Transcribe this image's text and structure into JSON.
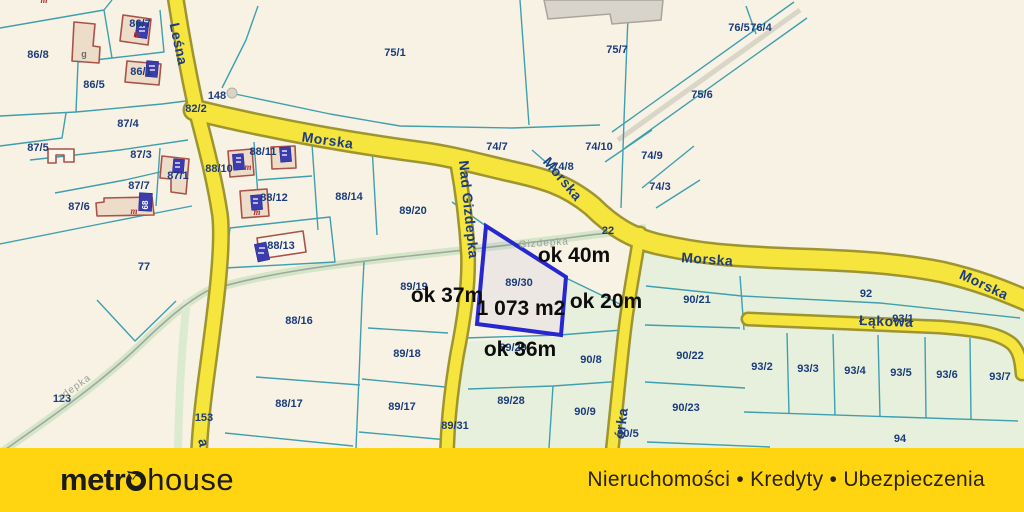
{
  "map": {
    "background_color": "#f7f2e3",
    "parcel_line_color": "#3f9fae",
    "road_fill": "#f6e53c",
    "road_border": "#9e9430",
    "green_parcel_fill": "#e6f0dc",
    "label_color": "#1b3b7c",
    "labels": [
      {
        "name": "parcel-86-8",
        "text": "86/8",
        "x": 38,
        "y": 58,
        "rot": 0,
        "kind": "parcel"
      },
      {
        "name": "parcel-86-7",
        "text": "86/7",
        "x": 140,
        "y": 27,
        "rot": 0,
        "kind": "parcel"
      },
      {
        "name": "parcel-86-1",
        "text": "86/1",
        "x": 141,
        "y": 75,
        "rot": 0,
        "kind": "parcel"
      },
      {
        "name": "parcel-86-5",
        "text": "86/5",
        "x": 94,
        "y": 88,
        "rot": 0,
        "kind": "parcel"
      },
      {
        "name": "parcel-148",
        "text": "148",
        "x": 217,
        "y": 99,
        "rot": 0,
        "kind": "parcel"
      },
      {
        "name": "parcel-82-2",
        "text": "82/2",
        "x": 196,
        "y": 112,
        "rot": 0,
        "kind": "parcel"
      },
      {
        "name": "parcel-87-4",
        "text": "87/4",
        "x": 128,
        "y": 127,
        "rot": 0,
        "kind": "parcel"
      },
      {
        "name": "parcel-87-5",
        "text": "87/5",
        "x": 38,
        "y": 151,
        "rot": 0,
        "kind": "parcel"
      },
      {
        "name": "parcel-87-3",
        "text": "87/3",
        "x": 141,
        "y": 158,
        "rot": 0,
        "kind": "parcel"
      },
      {
        "name": "parcel-87-1",
        "text": "87/1",
        "x": 178,
        "y": 179,
        "rot": 0,
        "kind": "parcel"
      },
      {
        "name": "parcel-88-10",
        "text": "88/10",
        "x": 219,
        "y": 172,
        "rot": 0,
        "kind": "parcel"
      },
      {
        "name": "parcel-87-7",
        "text": "87/7",
        "x": 139,
        "y": 189,
        "rot": 0,
        "kind": "parcel"
      },
      {
        "name": "parcel-87-6",
        "text": "87/6",
        "x": 79,
        "y": 210,
        "rot": 0,
        "kind": "parcel"
      },
      {
        "name": "parcel-88-11",
        "text": "88/11",
        "x": 263,
        "y": 155,
        "rot": 0,
        "kind": "parcel"
      },
      {
        "name": "parcel-88-12",
        "text": "88/12",
        "x": 274,
        "y": 201,
        "rot": 0,
        "kind": "parcel"
      },
      {
        "name": "parcel-88-14",
        "text": "88/14",
        "x": 349,
        "y": 200,
        "rot": 0,
        "kind": "parcel"
      },
      {
        "name": "parcel-88-13",
        "text": "88/13",
        "x": 281,
        "y": 249,
        "rot": 0,
        "kind": "parcel"
      },
      {
        "name": "parcel-77",
        "text": "77",
        "x": 144,
        "y": 270,
        "rot": 0,
        "kind": "parcel"
      },
      {
        "name": "parcel-88-16",
        "text": "88/16",
        "x": 299,
        "y": 324,
        "rot": 0,
        "kind": "parcel"
      },
      {
        "name": "parcel-89-19",
        "text": "89/19",
        "x": 414,
        "y": 290,
        "rot": 0,
        "kind": "parcel"
      },
      {
        "name": "parcel-89-20",
        "text": "89/20",
        "x": 413,
        "y": 214,
        "rot": 0,
        "kind": "parcel"
      },
      {
        "name": "parcel-75-1",
        "text": "75/1",
        "x": 395,
        "y": 56,
        "rot": 0,
        "kind": "parcel"
      },
      {
        "name": "parcel-75-7",
        "text": "75/7",
        "x": 617,
        "y": 53,
        "rot": 0,
        "kind": "parcel"
      },
      {
        "name": "parcel-76-5",
        "text": "76/5",
        "x": 739,
        "y": 31,
        "rot": 0,
        "kind": "parcel"
      },
      {
        "name": "parcel-76-4",
        "text": "76/4",
        "x": 761,
        "y": 31,
        "rot": 0,
        "kind": "parcel"
      },
      {
        "name": "parcel-75-6",
        "text": "75/6",
        "x": 702,
        "y": 98,
        "rot": 0,
        "kind": "parcel"
      },
      {
        "name": "parcel-74-7",
        "text": "74/7",
        "x": 497,
        "y": 150,
        "rot": 0,
        "kind": "parcel"
      },
      {
        "name": "parcel-74-10",
        "text": "74/10",
        "x": 599,
        "y": 150,
        "rot": 0,
        "kind": "parcel"
      },
      {
        "name": "parcel-74-9",
        "text": "74/9",
        "x": 652,
        "y": 159,
        "rot": 0,
        "kind": "parcel"
      },
      {
        "name": "parcel-74-8",
        "text": "74/8",
        "x": 563,
        "y": 170,
        "rot": 0,
        "kind": "parcel"
      },
      {
        "name": "parcel-74-3",
        "text": "74/3",
        "x": 660,
        "y": 190,
        "rot": 0,
        "kind": "parcel"
      },
      {
        "name": "parcel-22",
        "text": "22",
        "x": 608,
        "y": 234,
        "rot": 0,
        "kind": "parcel"
      },
      {
        "name": "parcel-88-17",
        "text": "88/17",
        "x": 289,
        "y": 407,
        "rot": 0,
        "kind": "parcel"
      },
      {
        "name": "parcel-89-18",
        "text": "89/18",
        "x": 407,
        "y": 357,
        "rot": 0,
        "kind": "parcel"
      },
      {
        "name": "parcel-89-17",
        "text": "89/17",
        "x": 402,
        "y": 410,
        "rot": 0,
        "kind": "parcel"
      },
      {
        "name": "parcel-89-31",
        "text": "89/31",
        "x": 455,
        "y": 429,
        "rot": 0,
        "kind": "parcel"
      },
      {
        "name": "parcel-89-28",
        "text": "89/28",
        "x": 511,
        "y": 404,
        "rot": 0,
        "kind": "parcel"
      },
      {
        "name": "parcel-89-29",
        "text": "89/29",
        "x": 513,
        "y": 351,
        "rot": 0,
        "kind": "parcel"
      },
      {
        "name": "parcel-90-8",
        "text": "90/8",
        "x": 591,
        "y": 363,
        "rot": 0,
        "kind": "parcel"
      },
      {
        "name": "parcel-90-9",
        "text": "90/9",
        "x": 585,
        "y": 415,
        "rot": 0,
        "kind": "parcel"
      },
      {
        "name": "parcel-90-5",
        "text": "90/5",
        "x": 628,
        "y": 437,
        "rot": 0,
        "kind": "parcel"
      },
      {
        "name": "parcel-90-21",
        "text": "90/21",
        "x": 697,
        "y": 303,
        "rot": 0,
        "kind": "parcel"
      },
      {
        "name": "parcel-92",
        "text": "92",
        "x": 866,
        "y": 297,
        "rot": 0,
        "kind": "parcel"
      },
      {
        "name": "parcel-93-1",
        "text": "93/1",
        "x": 903,
        "y": 322,
        "rot": 0,
        "kind": "parcel"
      },
      {
        "name": "parcel-90-22",
        "text": "90/22",
        "x": 690,
        "y": 359,
        "rot": 0,
        "kind": "parcel"
      },
      {
        "name": "parcel-90-23",
        "text": "90/23",
        "x": 686,
        "y": 411,
        "rot": 0,
        "kind": "parcel"
      },
      {
        "name": "parcel-93-2",
        "text": "93/2",
        "x": 762,
        "y": 370,
        "rot": 0,
        "kind": "parcel"
      },
      {
        "name": "parcel-93-3",
        "text": "93/3",
        "x": 808,
        "y": 372,
        "rot": 0,
        "kind": "parcel"
      },
      {
        "name": "parcel-93-4",
        "text": "93/4",
        "x": 855,
        "y": 374,
        "rot": 0,
        "kind": "parcel"
      },
      {
        "name": "parcel-93-5",
        "text": "93/5",
        "x": 901,
        "y": 376,
        "rot": 0,
        "kind": "parcel"
      },
      {
        "name": "parcel-93-6",
        "text": "93/6",
        "x": 947,
        "y": 378,
        "rot": 0,
        "kind": "parcel"
      },
      {
        "name": "parcel-93-7",
        "text": "93/7",
        "x": 1000,
        "y": 380,
        "rot": 0,
        "kind": "parcel"
      },
      {
        "name": "parcel-94",
        "text": "94",
        "x": 900,
        "y": 442,
        "rot": 0,
        "kind": "parcel"
      },
      {
        "name": "parcel-123",
        "text": "123",
        "x": 62,
        "y": 402,
        "rot": 0,
        "kind": "parcel"
      },
      {
        "name": "parcel-153",
        "text": "153",
        "x": 204,
        "y": 421,
        "rot": 0,
        "kind": "parcel"
      },
      {
        "name": "street-lesna",
        "text": "Leśna",
        "x": 174,
        "y": 45,
        "rot": 78,
        "kind": "street"
      },
      {
        "name": "street-morska-1",
        "text": "Morska",
        "x": 327,
        "y": 145,
        "rot": 8,
        "kind": "street"
      },
      {
        "name": "street-morska-2",
        "text": "Morska",
        "x": 559,
        "y": 182,
        "rot": 50,
        "kind": "street"
      },
      {
        "name": "street-morska-3",
        "text": "Morska",
        "x": 707,
        "y": 264,
        "rot": 4,
        "kind": "street"
      },
      {
        "name": "street-morska-4",
        "text": "Morska",
        "x": 982,
        "y": 289,
        "rot": 25,
        "kind": "street"
      },
      {
        "name": "street-nad-gizdepka",
        "text": "Nad Gizdepka",
        "x": 464,
        "y": 210,
        "rot": 84,
        "kind": "street"
      },
      {
        "name": "street-lakowa",
        "text": "Łąkowa",
        "x": 886,
        "y": 326,
        "rot": 2,
        "kind": "street"
      },
      {
        "name": "street-fragment-orka",
        "text": "órka",
        "x": 626,
        "y": 424,
        "rot": -83,
        "kind": "street"
      },
      {
        "name": "street-fragment-a",
        "text": "a",
        "x": 199,
        "y": 444,
        "rot": 78,
        "kind": "street"
      },
      {
        "name": "stream-gizdepka-label",
        "text": "Gizdepka",
        "x": 544,
        "y": 246,
        "rot": -4,
        "kind": "stream"
      },
      {
        "name": "stream-fragment-zdepka",
        "text": "zdepka",
        "x": 76,
        "y": 390,
        "rot": -35,
        "kind": "stream"
      },
      {
        "name": "building-letter-g",
        "text": "g",
        "x": 84,
        "y": 57,
        "rot": 0,
        "kind": "annot-g"
      },
      {
        "name": "building-letter-m-1",
        "text": "m",
        "x": 137,
        "y": 37,
        "rot": 0,
        "kind": "annot-red"
      },
      {
        "name": "building-letter-m-2",
        "text": "m",
        "x": 134,
        "y": 214,
        "rot": 0,
        "kind": "annot-red"
      },
      {
        "name": "building-letter-m-3",
        "text": "m",
        "x": 248,
        "y": 170,
        "rot": 0,
        "kind": "annot-red"
      },
      {
        "name": "building-letter-m-4",
        "text": "m",
        "x": 257,
        "y": 215,
        "rot": 0,
        "kind": "annot-red"
      },
      {
        "name": "building-letter-m-top",
        "text": "m",
        "x": 44,
        "y": 3,
        "rot": 0,
        "kind": "annot-red"
      },
      {
        "name": "house-number-68",
        "text": "68",
        "x": 148,
        "y": 205,
        "rot": -90,
        "kind": "plate"
      }
    ]
  },
  "highlight": {
    "parcel": "89/30",
    "area": "1 073 m2",
    "width_top": "ok 40m",
    "width_left": "ok 37m",
    "width_right": "ok 20m",
    "width_bottom": "ok 36m",
    "outline_color": "#2727cf"
  },
  "footer": {
    "brand_bold": "metr",
    "brand_regular": "house",
    "tagline": "Nieruchomości • Kredyty • Ubezpieczenia",
    "bar_color": "#ffd512"
  }
}
